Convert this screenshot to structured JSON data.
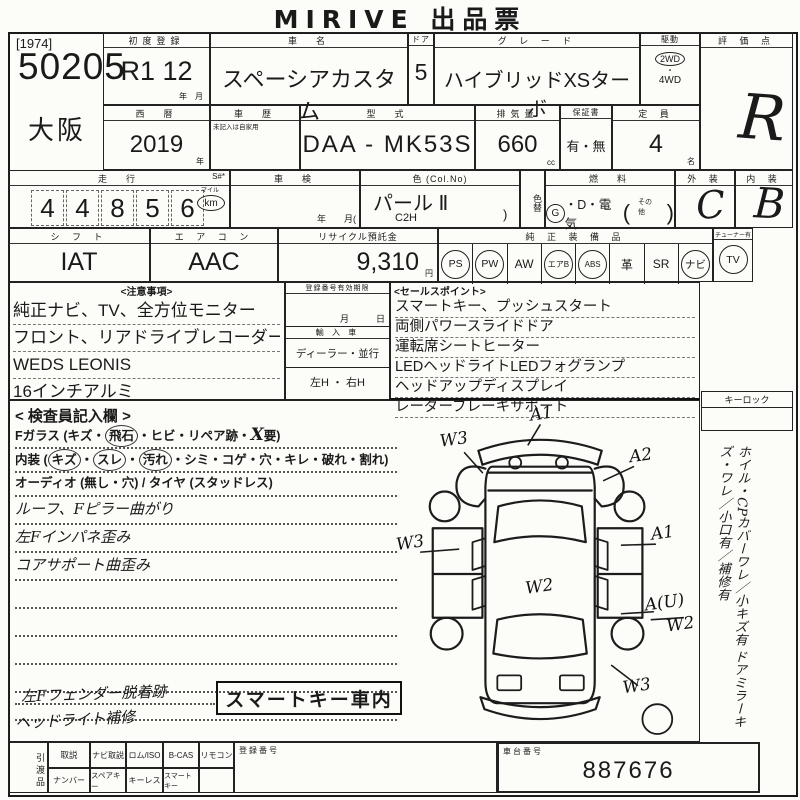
{
  "title": "MIRIVE 出品票",
  "lot": {
    "tag": "[1974]",
    "number": "50205",
    "region": "大阪"
  },
  "reg": {
    "first_label": "初度登録",
    "first_value": "R1  12",
    "first_units": "年　月",
    "year_label": "西　暦",
    "year": "2019",
    "year_unit": "年"
  },
  "vehicle": {
    "name_label": "車　名",
    "name": "スペーシアカスタム",
    "door_label": "ドア",
    "doors": "5",
    "grade_label": "グ レ ー ド",
    "grade": "ハイブリッドXSターボ",
    "drive_label": "駆動",
    "drive_selected": "2WD",
    "drive_sep": "・",
    "drive_other": "4WD",
    "history_label": "車　歴",
    "history_note": "未記入は自家用",
    "model_label": "型　式",
    "model": "DAA - MK53S",
    "disp_label": "排気量",
    "disp": "660",
    "disp_unit": "cc",
    "warranty_label": "保証書",
    "warranty": "有・無",
    "cap_label": "定 員",
    "cap": "4",
    "cap_unit": "名"
  },
  "score": {
    "label": "評 価 点",
    "value": "R",
    "ext_label": "外 装",
    "ext": "C",
    "int_label": "内 装",
    "int": "B"
  },
  "mileage": {
    "label": "走　行",
    "s_label": "S#*",
    "digits": [
      "4",
      "4",
      "8",
      "5",
      "6"
    ],
    "mile": "マイル",
    "km": "km",
    "shaken_label": "車　検",
    "shaken_foot": "年　　月("
  },
  "color": {
    "label": "色 (Col.No)",
    "value": "パール Ⅱ",
    "code": "C2H",
    "paren": ")",
    "change": "色替",
    "fuel_label": "燃　料",
    "fuel_g": "G",
    "fuel_rest": "・D・電気",
    "fuel_open": "(",
    "fuel_other": "その他",
    "fuel_close": ")"
  },
  "controls": {
    "shift_label": "シ フ ト",
    "shift": "IAT",
    "ac_label": "エ ア コ ン",
    "ac": "AAC",
    "recycle_label": "リサイクル預託金",
    "recycle": "9,310",
    "recycle_unit": "円"
  },
  "equipment": {
    "label": "純 正 装 備 品",
    "items": [
      {
        "t": "PS",
        "c": true
      },
      {
        "t": "PW",
        "c": true
      },
      {
        "t": "AW",
        "c": false
      },
      {
        "t": "エアB",
        "c": true
      },
      {
        "t": "ABS",
        "c": true
      },
      {
        "t": "革",
        "c": false
      },
      {
        "t": "SR",
        "c": false
      },
      {
        "t": "ナビ",
        "c": true
      }
    ],
    "tuner_label": "チューナー有",
    "tuner": "TV"
  },
  "notes": {
    "label": "<注意事項>",
    "lines": [
      "純正ナビ、TV、全方位モニター",
      "フロント、リアドライブレコーダー",
      "WEDS LEONIS",
      "16インチアルミ"
    ]
  },
  "middle": {
    "expiry_label": "登録番号有効期限",
    "expiry_units": "月　　　日",
    "import_label": "輸 入 車",
    "import_value": "ディーラー・並行",
    "handle_value": "左H ・ 右H"
  },
  "sales": {
    "label": "<セールスポイント>",
    "lines": [
      "スマートキー、プッシュスタート",
      "両側パワースライドドア",
      "運転席シートヒーター",
      "LEDヘッドライトLEDフォグランプ",
      "ヘッドアップディスプレイ",
      "レーダーブレーキサポート"
    ]
  },
  "inspector": {
    "label": "< 検査員記入欄 >",
    "glass": {
      "pre": "Fガラス (キズ・",
      "circled": "飛石",
      "mid": "・ヒビ・リペア跡・",
      "hand": "X",
      "post": "要)"
    },
    "interior": {
      "pre": "内装 (",
      "c1": "キズ",
      "d1": "・",
      "c2": "スレ",
      "d2": "・",
      "c3": "汚れ",
      "post": "・シミ・コゲ・穴・キレ・破れ・割れ)"
    },
    "audio": "オーディオ (無し・穴) / タイヤ (スタッドレス)",
    "hand_lines": [
      "ルーフ、Fピラー曲がり",
      "左Fインパネ歪み",
      "コアサポート曲歪み"
    ],
    "hand_note1": "左Fフェンダー脱着跡",
    "hand_note2": "ヘッドライト補修",
    "boxed": "スマートキー車内"
  },
  "diagram": {
    "marks": [
      {
        "t": "A1",
        "x": 152,
        "y": 16
      },
      {
        "t": "W3",
        "x": 64,
        "y": 42
      },
      {
        "t": "A2",
        "x": 252,
        "y": 58
      },
      {
        "t": "W3",
        "x": 20,
        "y": 146
      },
      {
        "t": "A1",
        "x": 274,
        "y": 136
      },
      {
        "t": "W2",
        "x": 150,
        "y": 190
      },
      {
        "t": "A(U)",
        "x": 276,
        "y": 206
      },
      {
        "t": "W2",
        "x": 292,
        "y": 228
      },
      {
        "t": "W3",
        "x": 248,
        "y": 290
      }
    ]
  },
  "side": {
    "keylock": "キーロック",
    "vtext1": "ホイル・CPカバーワレ／小キズ有",
    "vtext2": "ドアミラーキズ・ワレ／小口有／補修有"
  },
  "handover": {
    "side_label": "引渡品",
    "row1": [
      "取説",
      "ナビ取説",
      "ロム/ISO",
      "B-CAS",
      "リモコン"
    ],
    "row2": [
      "ナンバー",
      "スペアキー",
      "キーレス",
      "スマートキー"
    ],
    "reg_label": "登録番号",
    "chassis_label": "車台番号",
    "chassis": "887676"
  }
}
